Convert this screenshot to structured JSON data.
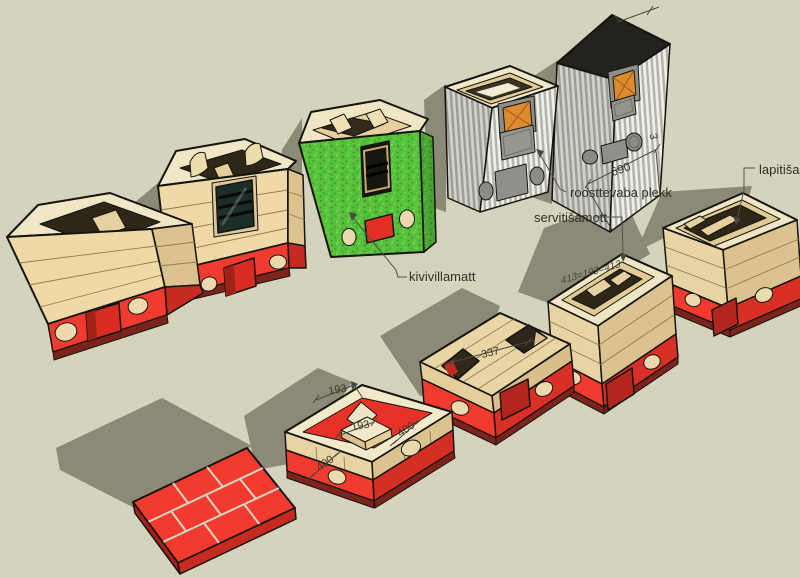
{
  "canvas": {
    "width": 800,
    "height": 578,
    "background": "#d5d2bd",
    "shadow_color": "#8c8977"
  },
  "palette": {
    "wood_front": "#eed9a7",
    "wood_side": "#dcc28e",
    "wood_top": "#f1e7c7",
    "cavity_dark": "#2e2718",
    "brick_red": "#f23a2f",
    "brick_red_dark": "#d42e25",
    "maroon_lip": "#7c231c",
    "opening_red": "#b3261e",
    "wool_green": "#57c13c",
    "metal_light": "#efeee8",
    "metal_dark": "#b2b2aa",
    "stove_top_black": "#24221d",
    "fire_glass_orange": "#de8a2e",
    "panel_gray": "#90908a",
    "text": "#30302a"
  },
  "annotations": {
    "material_labels": [
      {
        "id": "kivivillamatt",
        "text": "kivivillamatt"
      },
      {
        "id": "roostevaba_plekk",
        "text": "roosttevaba plekk"
      },
      {
        "id": "servitisamott",
        "text": "servitišamott"
      },
      {
        "id": "lapitisamott",
        "text": "lapitišamott"
      }
    ],
    "dimensions": [
      {
        "id": "dim_690",
        "text": "690"
      },
      {
        "id": "dim_3",
        "text": "3"
      },
      {
        "id": "dim_337",
        "text": "337"
      },
      {
        "id": "dim_193_notch",
        "text": "193"
      },
      {
        "id": "dim_193_inner",
        "text": "193"
      },
      {
        "id": "dim_400_right",
        "text": "400"
      },
      {
        "id": "dim_400_front",
        "text": "400"
      },
      {
        "id": "dim_top_edge",
        "text": "413=193=413"
      }
    ]
  }
}
